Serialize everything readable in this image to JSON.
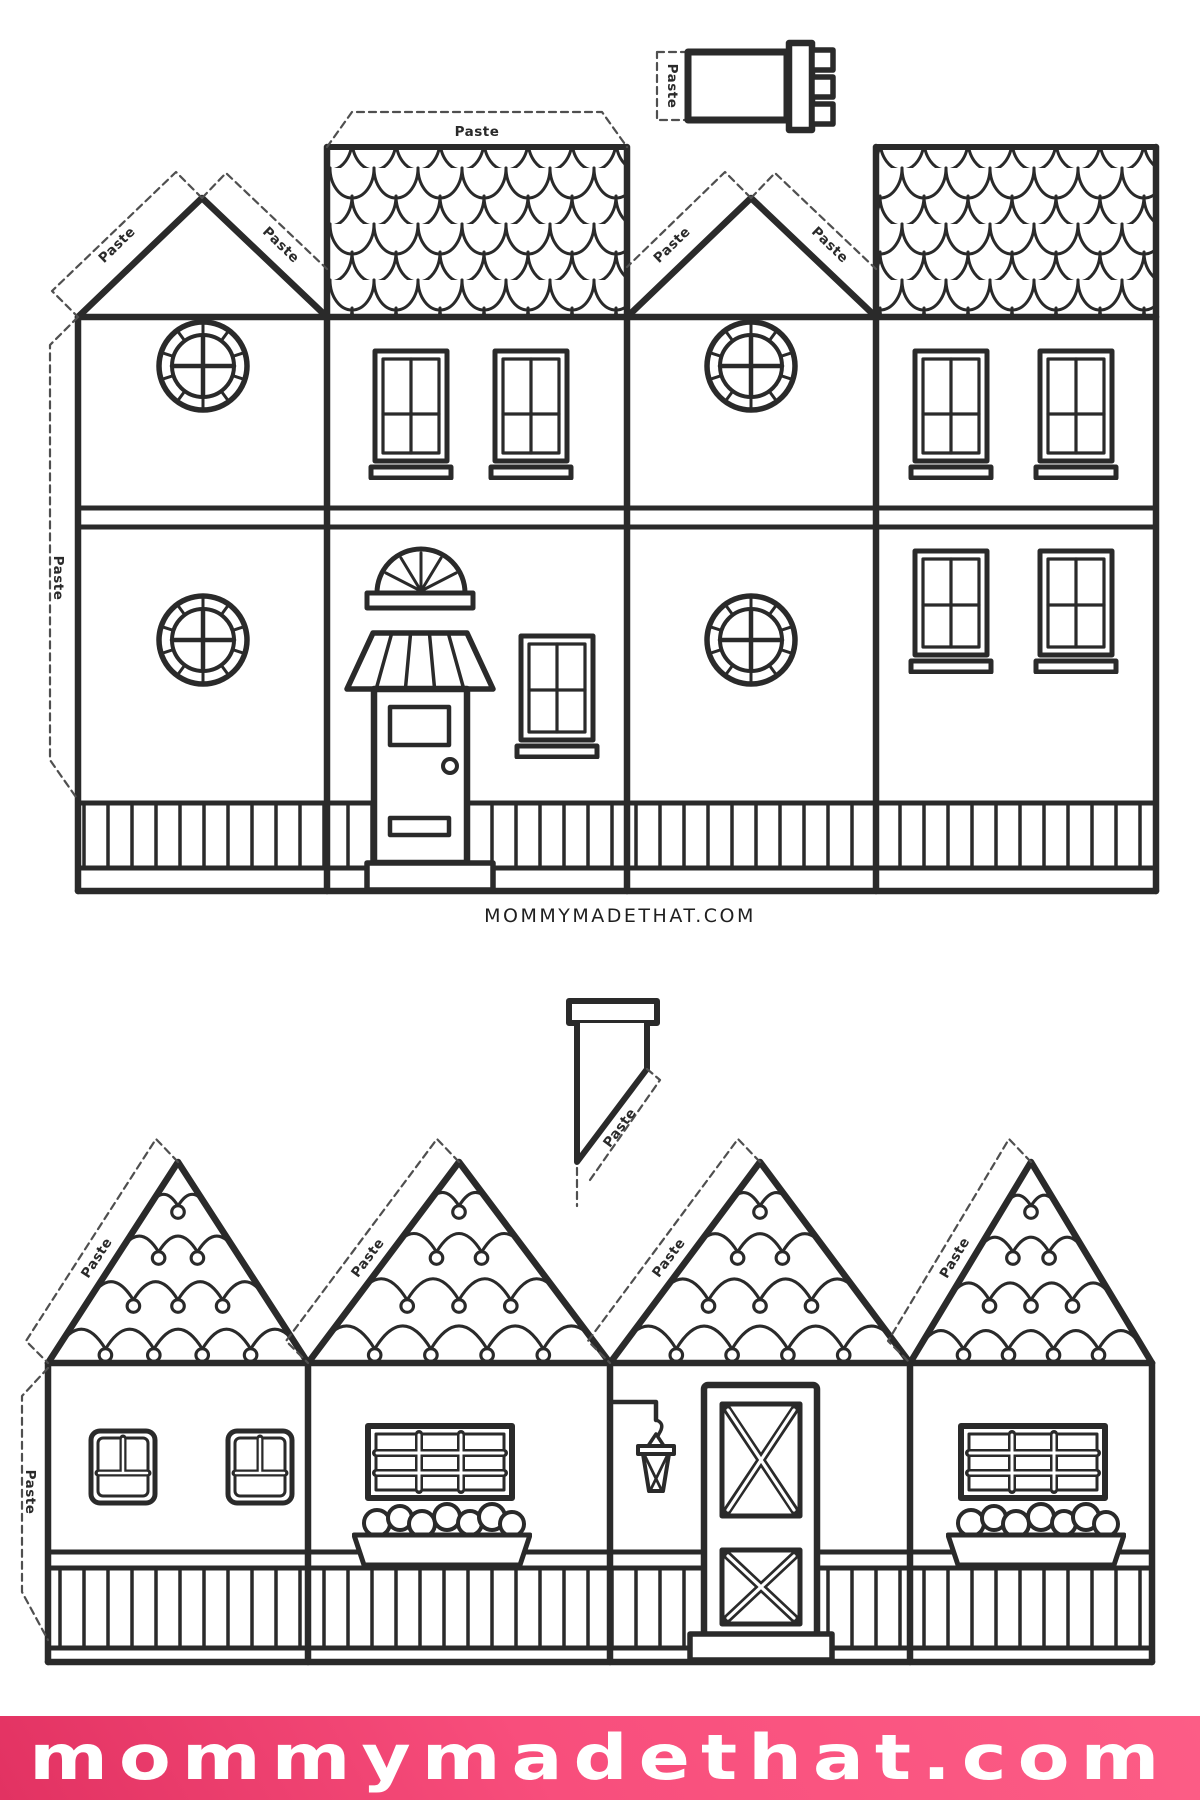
{
  "document": {
    "type_label": "printable-paper-house-craft-templates",
    "labels": {
      "paste": "Paste"
    },
    "caption": "MOMMYMADETHAT.COM",
    "footer": {
      "text": "mommymadethat.com",
      "bg_color": "#f94f7d",
      "bg_dark": "#e23262",
      "text_color": "#ffffff"
    },
    "ink_color": "#2a2a2a"
  }
}
